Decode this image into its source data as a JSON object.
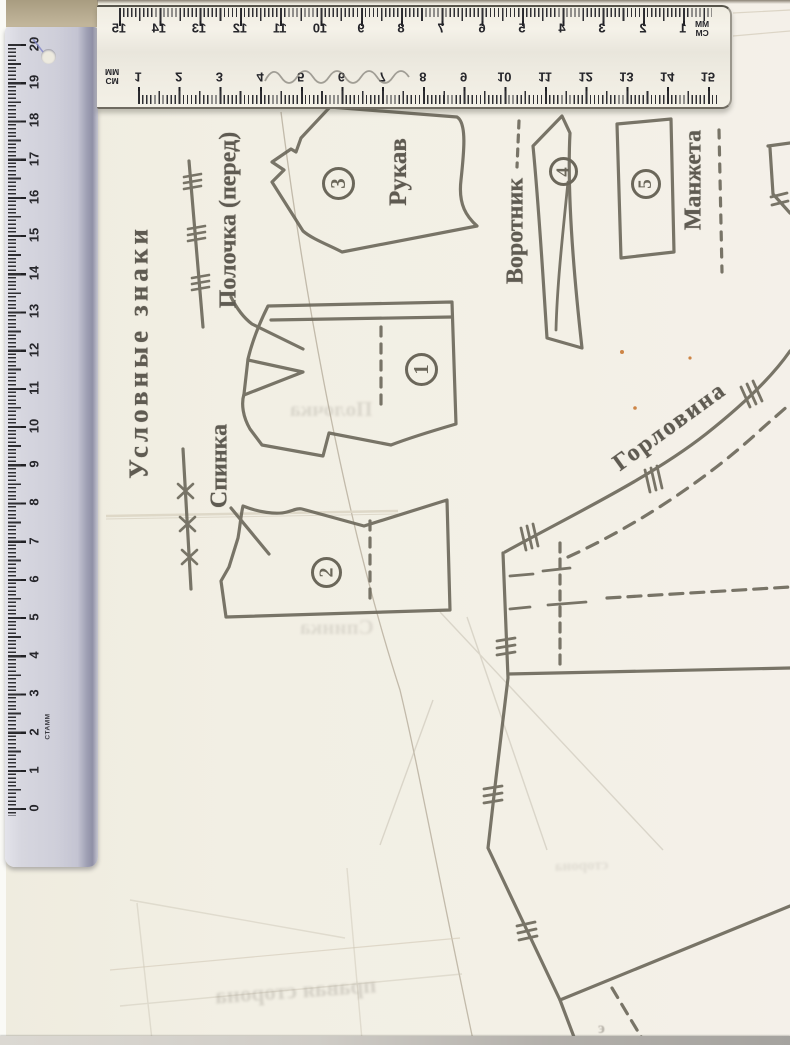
{
  "colors": {
    "paper": "#f2efe4",
    "pattern_ink": "#6b675a",
    "ruler_body": "#cfcfda",
    "ruler_edge": "#8f90a6",
    "beige_top": "#b3a78c",
    "bottom_strip": "#aeaba5",
    "speck_orange": "#c97a35",
    "pen_blue": "#8084c8"
  },
  "rulers": {
    "vertical": {
      "brand": "СТАММ",
      "numbers": [
        "20",
        "19",
        "18",
        "17",
        "16",
        "15",
        "14",
        "13",
        "12",
        "11",
        "10",
        "9",
        "8",
        "7",
        "6",
        "5",
        "4",
        "3",
        "2",
        "1",
        "0"
      ]
    },
    "horizontal": {
      "top_scale_numbers": [
        "15",
        "14",
        "13",
        "12",
        "11",
        "10",
        "9",
        "8",
        "7",
        "6",
        "5",
        "4",
        "3",
        "2",
        "1"
      ],
      "bottom_scale_numbers": [
        "1",
        "2",
        "3",
        "4",
        "5",
        "6",
        "7",
        "8",
        "9",
        "10",
        "11",
        "12",
        "13",
        "14",
        "15"
      ],
      "top_unit_primary": "MM",
      "top_unit_secondary": "CM",
      "bottom_unit_primary": "CM",
      "bottom_unit_secondary": "MM"
    }
  },
  "pattern": {
    "legend_title": "Условные знаки",
    "legend": [
      {
        "label": "Полочка (перед)",
        "symbol": "line-with-triple-hash"
      },
      {
        "label": "Спинка",
        "symbol": "line-with-x-marks"
      }
    ],
    "pieces": [
      {
        "number": "1",
        "label": ""
      },
      {
        "number": "2",
        "label": ""
      },
      {
        "number": "3",
        "label": "Рукав"
      },
      {
        "number": "4",
        "label": "Воротник"
      },
      {
        "number": "5",
        "label": "Манжета"
      }
    ],
    "curve_label": "Горловина",
    "showthrough": {
      "word1": "Полочка",
      "word2": "Спинка",
      "word3": "правая сторона",
      "word4": "сторона",
      "stray_glyph": "э"
    }
  }
}
